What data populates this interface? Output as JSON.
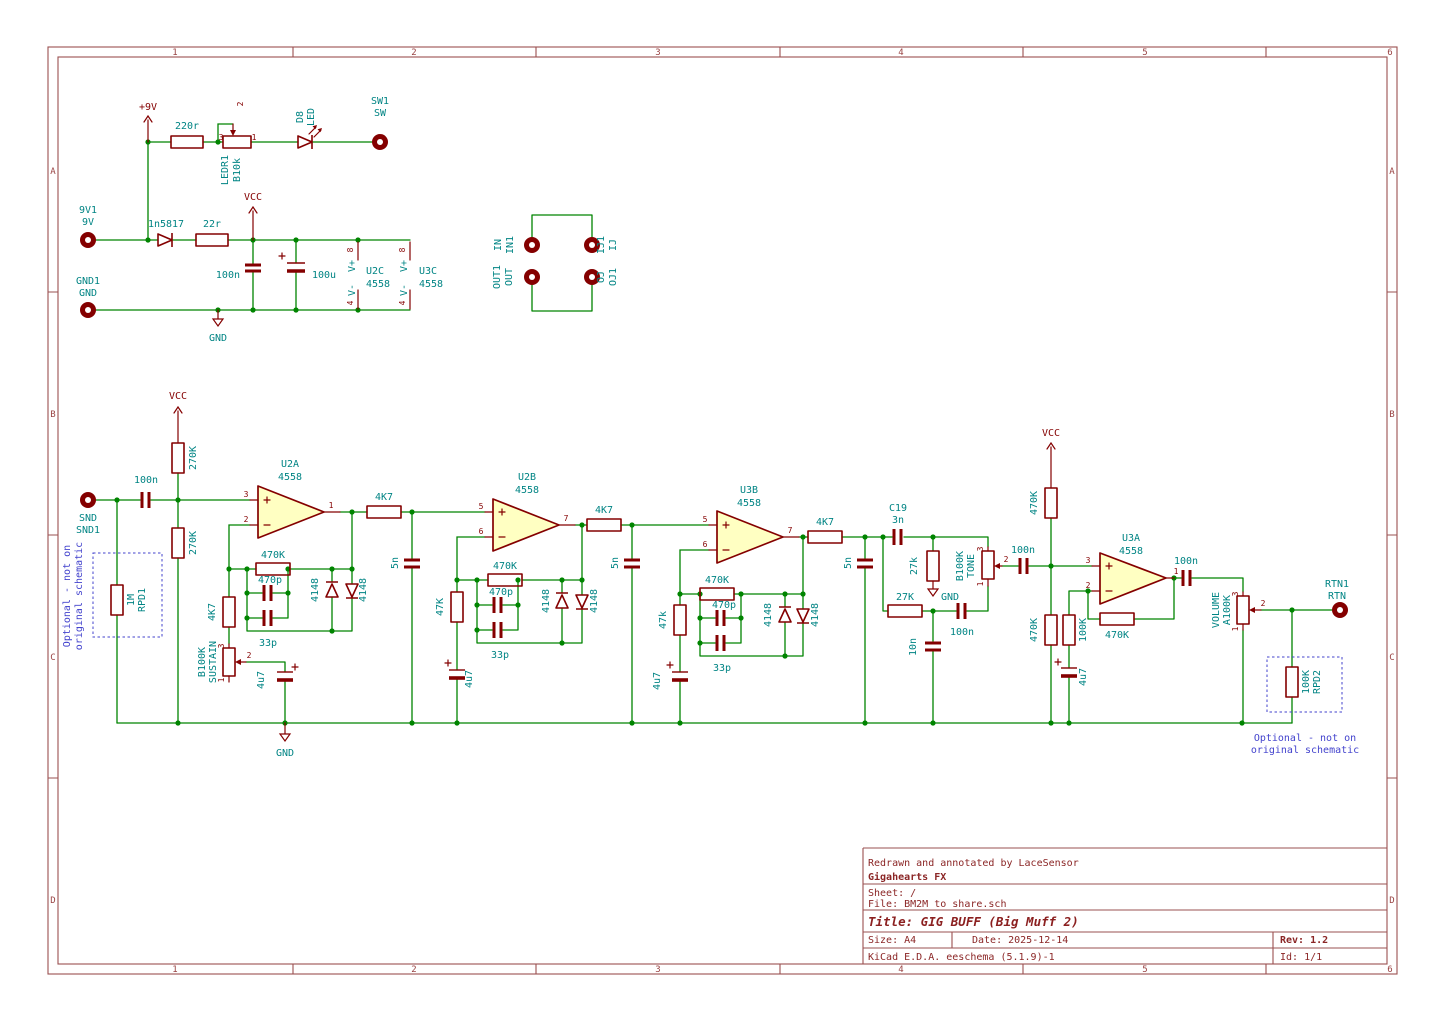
{
  "sheet": {
    "cols": [
      "1",
      "2",
      "3",
      "4",
      "5",
      "6"
    ],
    "rows": [
      "A",
      "B",
      "C",
      "D"
    ]
  },
  "titleblock": {
    "credit": "Redrawn and annotated by LaceSensor",
    "company": "Gigahearts FX",
    "sheet": "Sheet: /",
    "file": "File: BM2M to share.sch",
    "title": "Title: GIG BUFF (Big Muff 2)",
    "size": "Size: A4",
    "date": "Date: 2025-12-14",
    "rev": "Rev: 1.2",
    "tool": "KiCad E.D.A.  eeschema (5.1.9)-1",
    "id": "Id: 1/1"
  },
  "power": {
    "p9v": "+9V",
    "vcc": "VCC",
    "gnd": "GND"
  },
  "pins": {
    "n1": "1",
    "n2": "2",
    "n3": "3",
    "n4": "4",
    "n5": "5",
    "n6": "6",
    "n7": "7",
    "n8": "8",
    "vplus": "V+",
    "vminus": "V-"
  },
  "vals": {
    "r220": "220r",
    "b10k": "B10k",
    "led": "LED",
    "schottky": "1n5817",
    "r22": "22r",
    "c100n": "100n",
    "c100u": "100u",
    "opamp": "4558",
    "r270k": "270K",
    "r470k": "470K",
    "c470p": "470p",
    "c33p": "33p",
    "d4148": "4148",
    "r4k7": "4K7",
    "c5n": "5n",
    "r47k": "47K",
    "r47k_lc": "47k",
    "c4u7": "4u7",
    "b100k": "B100K",
    "c3n": "3n",
    "r27k": "27K",
    "r27k_lc": "27k",
    "c10n": "10n",
    "r100k": "100K",
    "r1m": "1M",
    "a100k": "A100K"
  },
  "refs": {
    "ledr1": "LEDR1",
    "d8": "D8",
    "sw1": "SW1",
    "sw": "SW",
    "j9v1": "9V1",
    "j9v": "9V",
    "gnd1": "GND1",
    "u2a": "U2A",
    "u2b": "U2B",
    "u2c": "U2C",
    "u3a": "U3A",
    "u3b": "U3B",
    "u3c": "U3C",
    "c19": "C19",
    "snd": "SND",
    "snd1": "SND1",
    "rtn": "RTN",
    "rtn1": "RTN1",
    "rpd1": "RPD1",
    "rpd2": "RPD2",
    "jin": "IN",
    "jin1": "IN1",
    "jij": "IJ",
    "jij1": "IJ1",
    "jout": "OUT",
    "jout1": "OUT1",
    "joj": "OJ",
    "joj1": "OJ1",
    "sustain": "SUSTAIN",
    "tone": "TONE",
    "volume": "VOLUME"
  },
  "notes": {
    "line1": "Optional - not on",
    "line2": "original schematic"
  },
  "colors": {
    "wire": "#008400",
    "symbol": "#840000",
    "field": "#008484",
    "note": "#4343cd",
    "border": "#9a5050",
    "opamp_fill": "#ffffc2"
  }
}
